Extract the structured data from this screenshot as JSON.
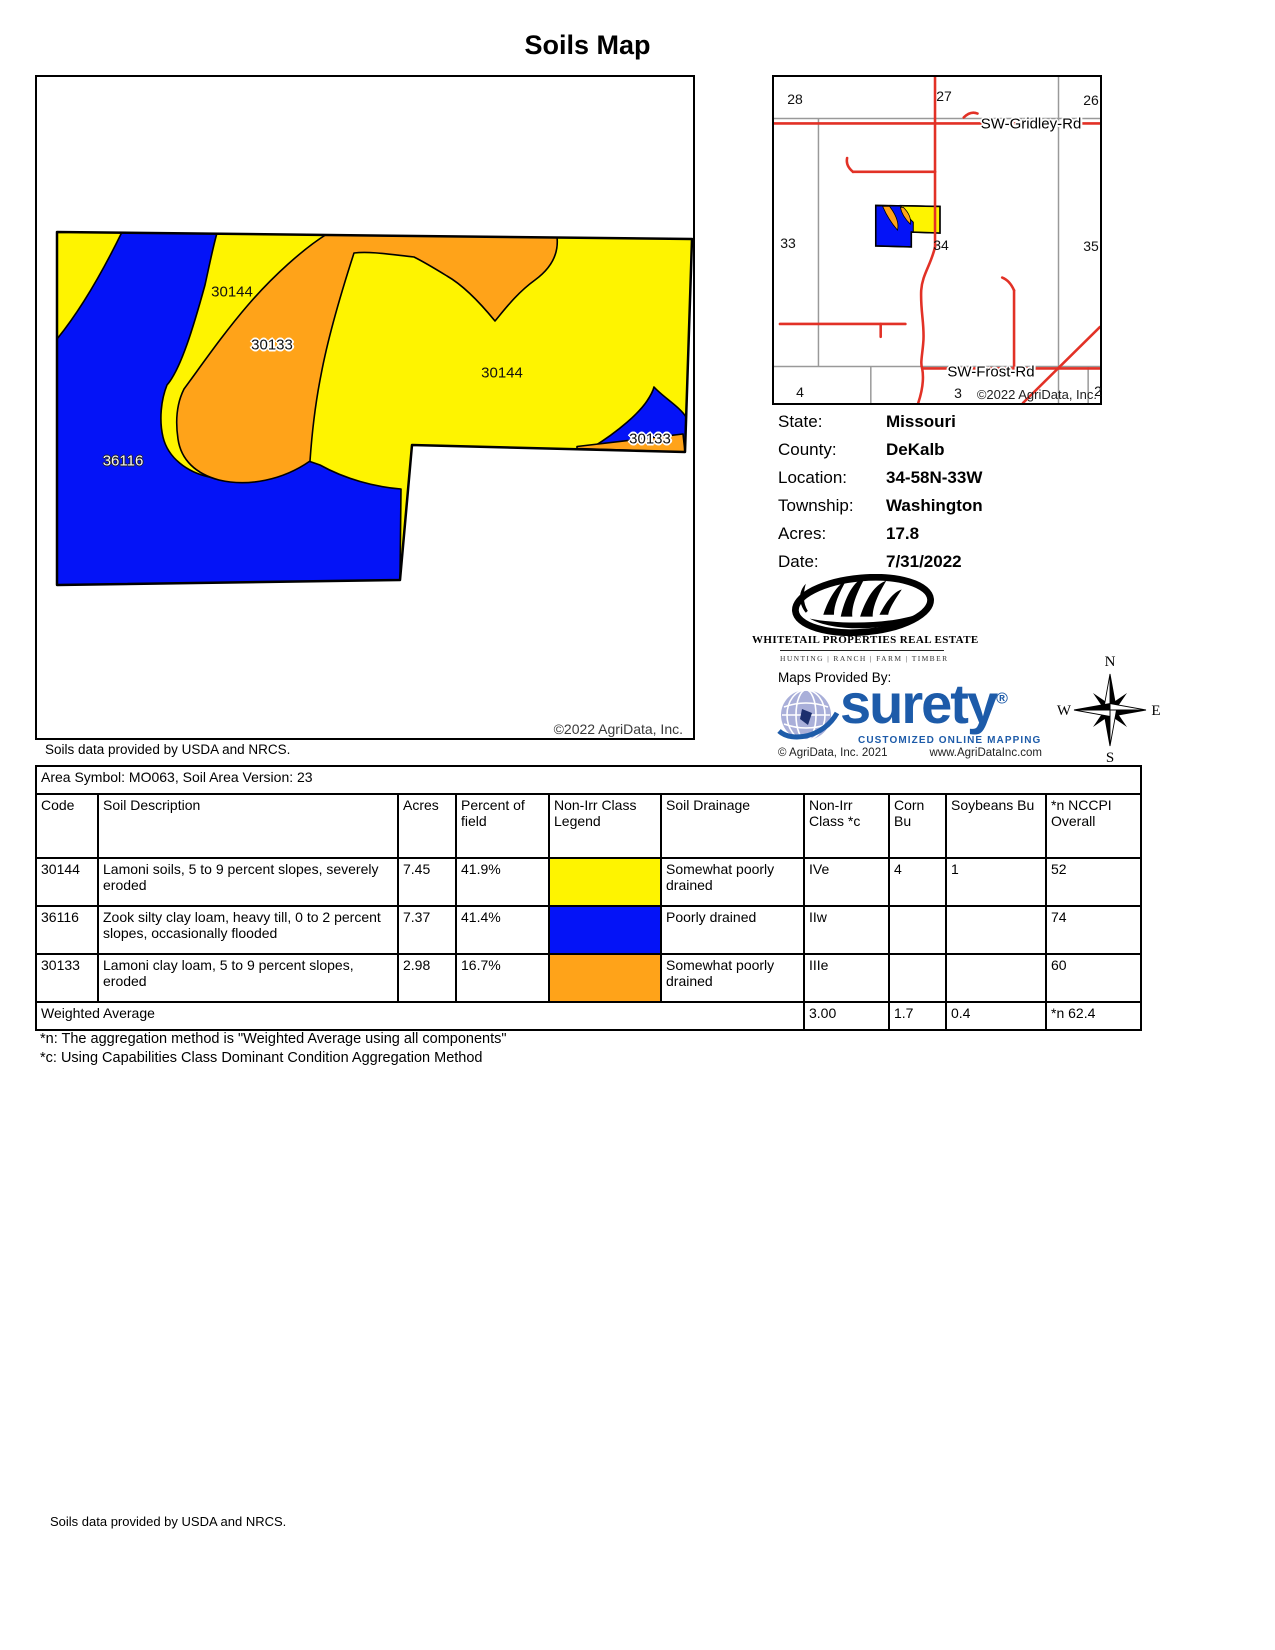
{
  "title": "Soils Map",
  "soils_note": "Soils data provided by USDA and NRCS.",
  "main_map": {
    "labels": [
      "30144",
      "30133",
      "30144",
      "36116",
      "30133"
    ],
    "copyright": "©2022 AgriData, Inc."
  },
  "locator": {
    "sections": [
      "28",
      "27",
      "26",
      "33",
      "34",
      "35",
      "4",
      "3",
      "2"
    ],
    "road_gridley": "SW-Gridley-Rd",
    "road_frost": "SW-Frost-Rd",
    "copyright": "©2022 AgriData, Inc."
  },
  "info": {
    "rows": [
      {
        "label": "State:",
        "value": "Missouri"
      },
      {
        "label": "County:",
        "value": "DeKalb"
      },
      {
        "label": "Location:",
        "value": "34-58N-33W"
      },
      {
        "label": "Township:",
        "value": "Washington"
      },
      {
        "label": "Acres:",
        "value": "17.8"
      },
      {
        "label": "Date:",
        "value": "7/31/2022"
      }
    ]
  },
  "branding": {
    "whitetail_name": "WHITETAIL PROPERTIES REAL ESTATE",
    "whitetail_tagline": "HUNTING | RANCH | FARM | TIMBER",
    "maps_provided_by": "Maps Provided By:",
    "surety_wordmark": "surety",
    "surety_reg": "®",
    "surety_tagline": "CUSTOMIZED ONLINE MAPPING",
    "agridata_copyright": "© AgriData, Inc. 2021",
    "agridata_url": "www.AgriDataInc.com"
  },
  "compass": {
    "north": "N",
    "east": "E",
    "south": "S",
    "west": "W"
  },
  "table": {
    "area_line": "Area Symbol: MO063, Soil Area Version: 23",
    "headers": [
      "Code",
      "Soil Description",
      "Acres",
      "Percent of field",
      "Non-Irr Class Legend",
      "Soil Drainage",
      "Non-Irr Class *c",
      "Corn Bu",
      "Soybeans Bu",
      "*n NCCPI Overall"
    ],
    "rows": [
      {
        "code": "30144",
        "description": "Lamoni soils, 5 to 9 percent slopes, severely eroded",
        "acres": "7.45",
        "percent": "41.9%",
        "color": "#fef400",
        "drainage": "Somewhat poorly drained",
        "nonirr_class": "IVe",
        "corn_bu": "4",
        "soybeans_bu": "1",
        "nccpi": "52"
      },
      {
        "code": "36116",
        "description": "Zook silty clay loam, heavy till, 0 to 2 percent slopes, occasionally flooded",
        "acres": "7.37",
        "percent": "41.4%",
        "color": "#0413f7",
        "drainage": "Poorly drained",
        "nonirr_class": "IIw",
        "corn_bu": "",
        "soybeans_bu": "",
        "nccpi": "74"
      },
      {
        "code": "30133",
        "description": "Lamoni clay loam, 5 to 9 percent slopes, eroded",
        "acres": "2.98",
        "percent": "16.7%",
        "color": "#ffa319",
        "drainage": "Somewhat poorly drained",
        "nonirr_class": "IIIe",
        "corn_bu": "",
        "soybeans_bu": "",
        "nccpi": "60"
      }
    ],
    "weighted_average": {
      "label": "Weighted Average",
      "nonirr_class": "3.00",
      "corn_bu": "1.7",
      "soybeans_bu": "0.4",
      "nccpi": "*n 62.4"
    }
  },
  "footnotes": [
    "*n: The aggregation method is \"Weighted Average using all components\"",
    "*c:  Using Capabilities Class Dominant Condition Aggregation Method"
  ],
  "colors": {
    "soil_yellow": "#fef400",
    "soil_blue": "#0413f7",
    "soil_orange": "#ffa319",
    "road_red": "#e23126",
    "surety_blue": "#1d5ba9"
  }
}
